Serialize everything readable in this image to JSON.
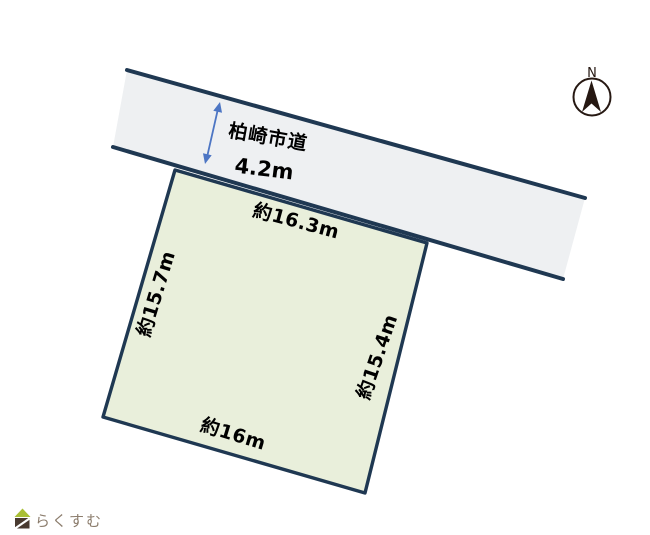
{
  "road": {
    "name": "柏崎市道",
    "width_label": "4.2m"
  },
  "parcel": {
    "top_dimension": "約16.3m",
    "left_dimension": "約15.7m",
    "right_dimension": "約15.4m",
    "bottom_dimension": "約16m"
  },
  "compass": {
    "north": "N"
  },
  "logo": {
    "text": "らくすむ"
  },
  "colors": {
    "outline": "#1f3852",
    "road_fill": "#eef0f2",
    "parcel_fill": "#e9efdb",
    "label_text": "#000000",
    "dimension_arrow": "#4d76c4",
    "compass_dark": "#261812",
    "compass_fill": "#ffffff",
    "logo_text": "#8c7d6d",
    "logo_roof": "#a9bf36",
    "logo_body": "#493a30",
    "logo_slash": "#ffffff"
  }
}
